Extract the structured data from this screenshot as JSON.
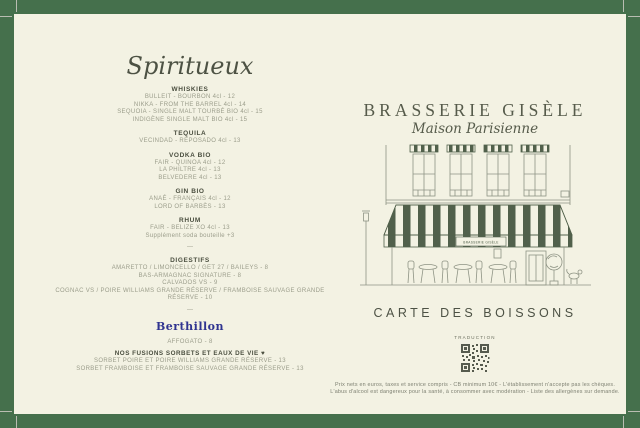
{
  "colors": {
    "border_green": "#45704c",
    "paper": "#f3f2e3",
    "ink_dark": "#4d5244",
    "ink_light": "#9b9d8b",
    "awning_green": "#51604b",
    "berthillon_blue": "#2f3490"
  },
  "left": {
    "heading": "Spiritueux",
    "separator": "—",
    "sections": [
      {
        "title": "WHISKIES",
        "items": [
          "BULLEIT - BOURBON 4cl - 12",
          "NIKKA - FROM THE BARREL 4cl - 14",
          "SEQUOIA - SINGLE MALT TOURBÉ BIO 4cl - 15",
          "INDIGÈNE SINGLE MALT BIO 4cl - 15"
        ]
      },
      {
        "title": "TEQUILA",
        "items": [
          "VECINDAD - REPOSADO 4cl - 13"
        ]
      },
      {
        "title": "VODKA BIO",
        "items": [
          "FAIR - QUINOA 4cl - 12",
          "LA PHILTRE 4cl - 13",
          "BELVEDERE 4cl - 13"
        ]
      },
      {
        "title": "GIN BIO",
        "items": [
          "ANAÉ - FRANÇAIS 4cl - 12",
          "LORD OF BARBÈS - 13"
        ]
      },
      {
        "title": "RHUM",
        "items": [
          "FAIR - BELIZE XO 4cl - 13",
          "Supplément soda bouteille +3"
        ]
      },
      {
        "title": "DIGESTIFS",
        "items": [
          "AMARETTO / LIMONCELLO / GET 27 / BAILEYS - 8",
          "BAS-ARMAGNAC SIGNATURE - 8",
          "CALVADOS VS - 9",
          "COGNAC VS / POIRE WILLIAMS GRANDE RÉSERVE / FRAMBOISE SAUVAGE GRANDE RÉSERVE - 10"
        ]
      }
    ],
    "berthillon": {
      "logo": "Berthillon",
      "affogato": "AFFOGATO - 8",
      "fusions_title": "NOS FUSIONS SORBETS ET EAUX DE VIE ♥",
      "fusions_items": [
        "SORBET POIRE ET POIRE WILLIAMS GRANDE RÉSERVE - 13",
        "SORBET FRAMBOISE ET FRAMBOISE SAUVAGE GRANDE RÉSERVE - 13"
      ]
    }
  },
  "right": {
    "title": "BRASSERIE GISÈLE",
    "subtitle": "Maison Parisienne",
    "storefront_sign": "BRASSERIE GISÈLE",
    "menu_title": "CARTE DES BOISSONS",
    "qr_label": "TRADUCTION",
    "footnote_line1": "Prix nets en euros, taxes et service compris - CB minimum 10€ - L'établissement n'accepte pas les chèques.",
    "footnote_line2": "L'abus d'alcool est dangereux pour la santé, à consommer avec modération - Liste des allergènes sur demande."
  }
}
